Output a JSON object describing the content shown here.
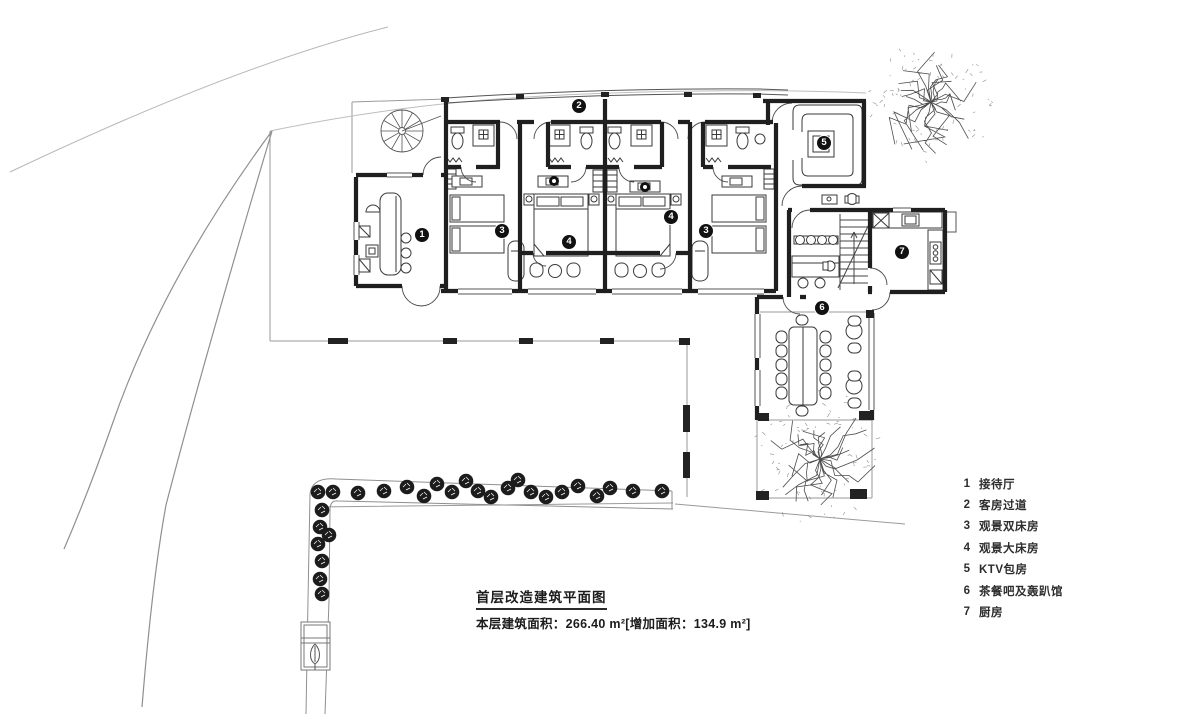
{
  "title_block": {
    "title": "首层改造建筑平面图",
    "area_line": "本层建筑面积：266.40 m²[增加面积：134.9 m²]"
  },
  "legend": {
    "items": [
      {
        "num": "1",
        "label": "接待厅"
      },
      {
        "num": "2",
        "label": "客房过道"
      },
      {
        "num": "3",
        "label": "观景双床房"
      },
      {
        "num": "4",
        "label": "观景大床房"
      },
      {
        "num": "5",
        "label": "KTV包房"
      },
      {
        "num": "6",
        "label": "茶餐吧及轰趴馆"
      },
      {
        "num": "7",
        "label": "厨房"
      }
    ]
  },
  "rooms": {
    "markers": [
      {
        "num": "1",
        "name": "reception-hall",
        "x": 422,
        "y": 235
      },
      {
        "num": "2",
        "name": "guest-corridor",
        "x": 579,
        "y": 106
      },
      {
        "num": "3",
        "name": "twin-room-west",
        "x": 502,
        "y": 231
      },
      {
        "num": "4",
        "name": "king-room-west",
        "x": 569,
        "y": 242
      },
      {
        "num": "4",
        "name": "king-room-east",
        "x": 671,
        "y": 217
      },
      {
        "num": "3",
        "name": "twin-room-east",
        "x": 706,
        "y": 231
      },
      {
        "num": "5",
        "name": "ktv-room",
        "x": 824,
        "y": 143
      },
      {
        "num": "6",
        "name": "tea-bar-party-room",
        "x": 822,
        "y": 308
      },
      {
        "num": "7",
        "name": "kitchen",
        "x": 902,
        "y": 252
      }
    ]
  },
  "colors": {
    "wall": "#1f1f1f",
    "thin_line": "#555555",
    "site_line": "#8f8f8f",
    "marker_bg": "#111111",
    "marker_text": "#ffffff",
    "text": "#2d2d2d"
  }
}
